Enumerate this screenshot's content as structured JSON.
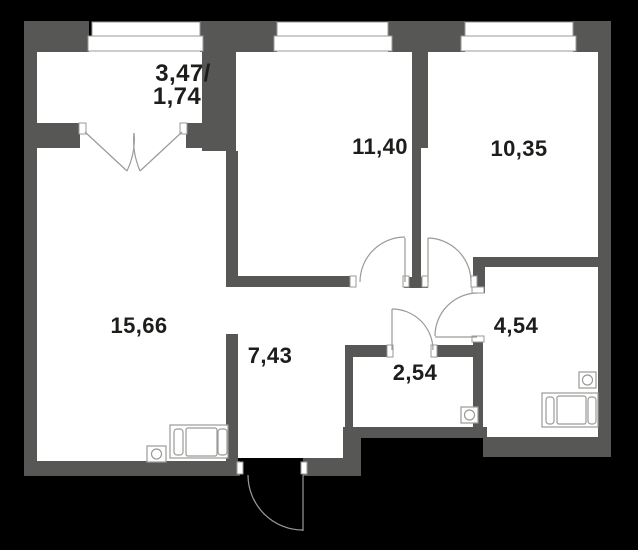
{
  "plan": {
    "type": "apartment-floor-plan",
    "rooms": {
      "balcony": {
        "name": "balcony",
        "area_total": "3,47/",
        "area_reduced": "1,74"
      },
      "living_room": {
        "name": "living-room",
        "area": "15,66"
      },
      "room_a": {
        "name": "room-a",
        "area": "11,40"
      },
      "room_b": {
        "name": "room-b",
        "area": "10,35"
      },
      "hallway": {
        "name": "hallway",
        "area": "7,43"
      },
      "wc": {
        "name": "wc",
        "area": "2,54"
      },
      "bathroom": {
        "name": "bathroom",
        "area": "4,54"
      }
    },
    "fixtures": {
      "kitchen": [
        "stove-icon",
        "sink-icon"
      ],
      "bathroom": [
        "bathtub-icon",
        "drain-icon"
      ],
      "wc": [
        "drain-icon"
      ],
      "windows": 3,
      "doors": [
        "entrance-door",
        "balcony-french-door",
        "room-a-door",
        "room-b-door",
        "bathroom-door",
        "wc-door"
      ]
    }
  },
  "colors": {
    "background": "#000000",
    "wall": "#575756",
    "floor": "#ffffff",
    "line": "#9a9a98",
    "text": "#1d1d1b"
  }
}
